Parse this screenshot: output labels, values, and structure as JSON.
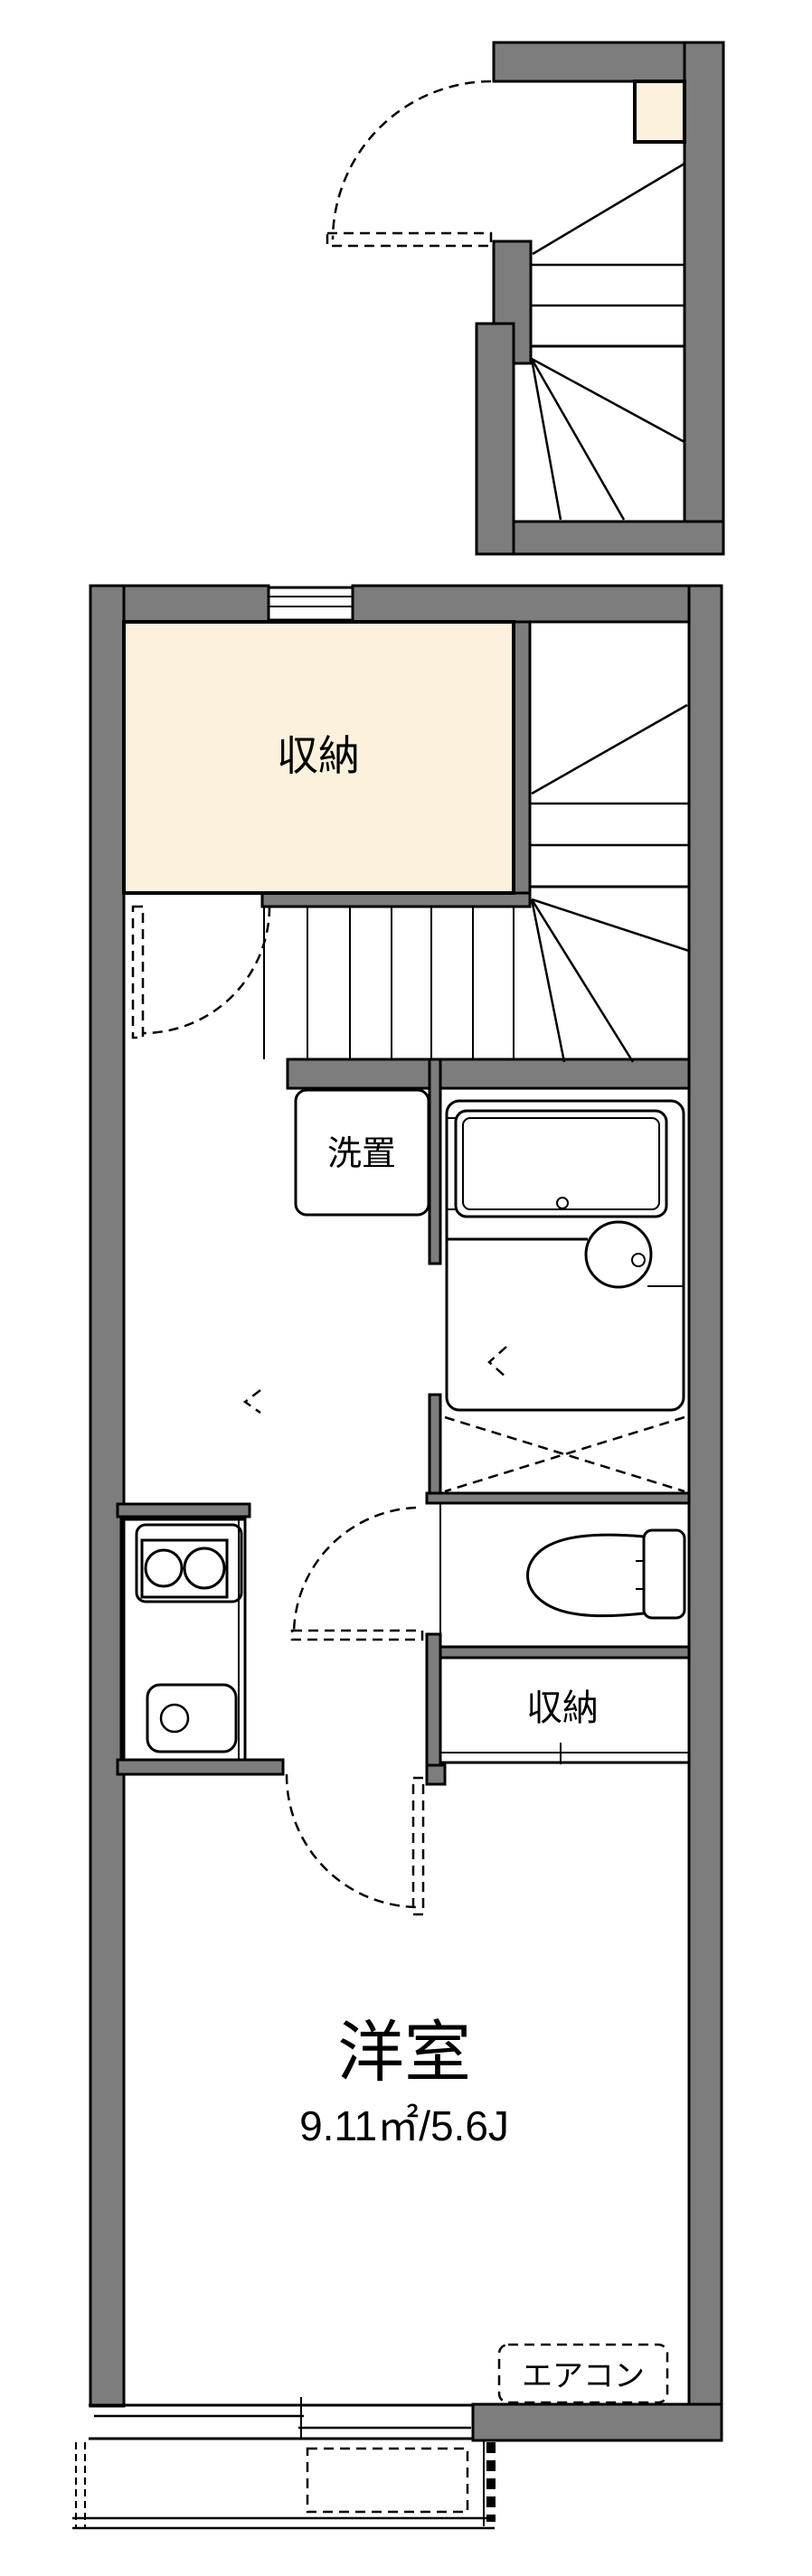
{
  "floorplan": {
    "labels": {
      "storage_upper": "収納",
      "laundry": "洗置",
      "storage_lower": "収納",
      "western_room": "洋室",
      "western_room_area": "9.11㎡/5.6J",
      "aircon": "エアコン"
    },
    "colors": {
      "background": "#ffffff",
      "wall_fill": "#7d7d7d",
      "outline": "#000000",
      "storage_fill": "#fcf1dc",
      "fixture_fill": "#e2ebf8",
      "toilet_room_fill": "#dce7f6"
    }
  }
}
